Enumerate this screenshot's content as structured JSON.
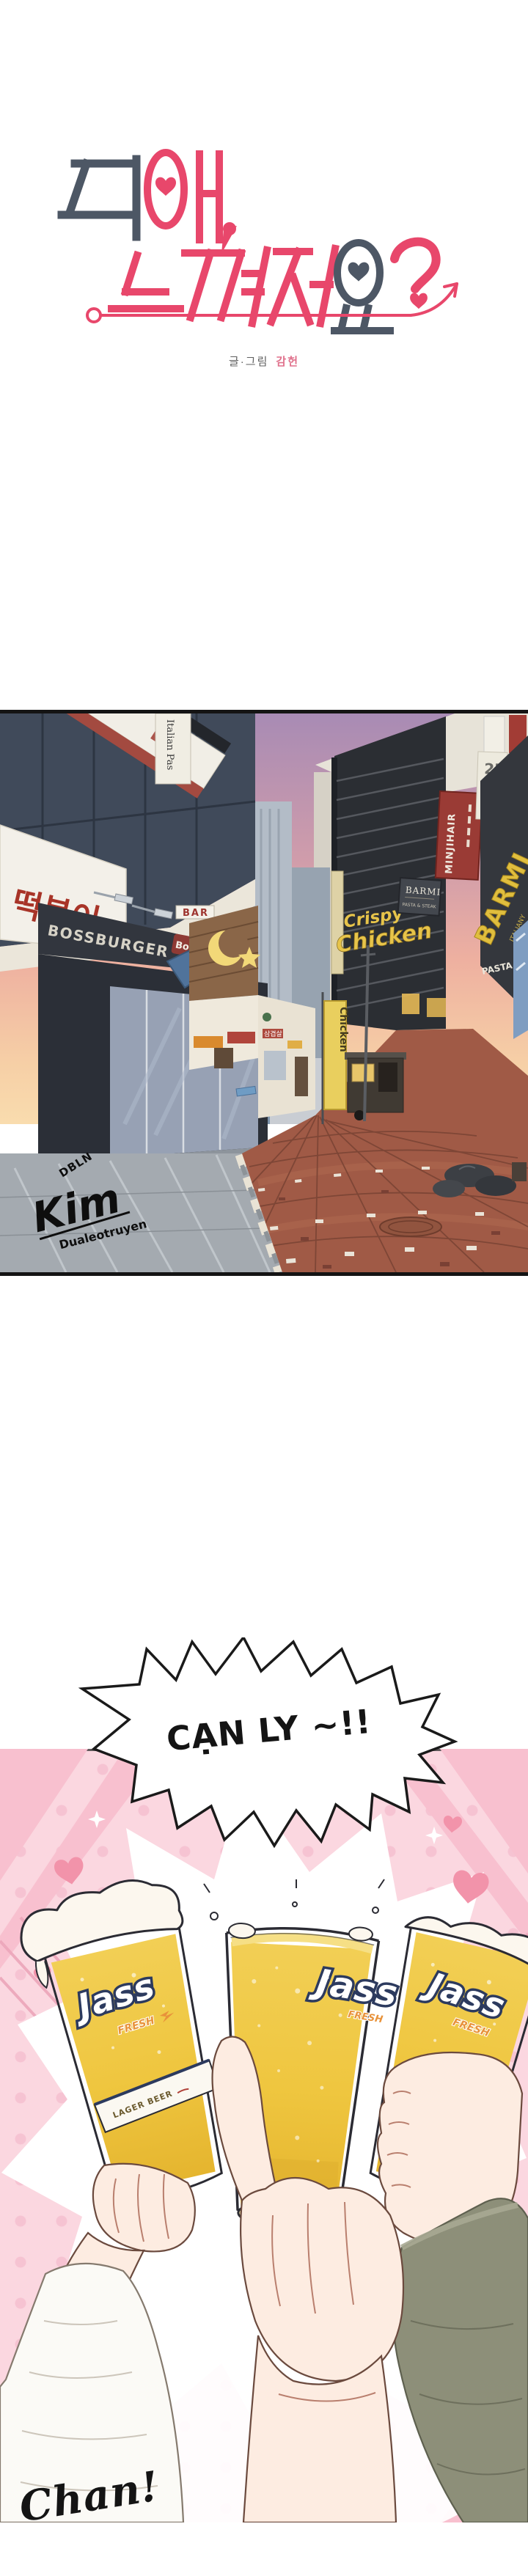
{
  "page": {
    "background": "#ffffff"
  },
  "title_logo": {
    "full_title": "뒤에, 느껴져요?",
    "slate_color": "#4d5765",
    "pink_color": "#e8476b",
    "credit_label": "글·그림",
    "credit_name": "감헌"
  },
  "street_panel": {
    "border_color": "#141414",
    "signs": {
      "italian_pasta_banner": "Italian Pas",
      "tteokbokki_sign": "떡볶이",
      "bar_sign": "BAR",
      "bossburger_sign": "BOSSBURGER",
      "bo_chip": "Bo",
      "bo_logo_b": "B",
      "crispy": "Crispy",
      "chicken": "Chicken",
      "barmi_hanging_title": "BARMI",
      "barmi_hanging_sub": "PASTA & STEAK",
      "minjihair_sign": "MINJIHAIR",
      "floor_sign": "2F",
      "barmi_wall_logo": "BARMI",
      "barmi_wall_italiany": "ITALIANY",
      "barmi_wall_sub": "PASTA & STEAK",
      "samgyeopsal_sign": "삼겹살",
      "chicken_banner": "Chicken"
    },
    "watermark": {
      "line1": "DBLN",
      "line2": "Kim",
      "line3": "Dualeotruyen"
    }
  },
  "speech_bubble": {
    "text": "CẠN LY ~!!",
    "text_color": "#141414"
  },
  "beer_panel": {
    "background_pink": "#fbd7e0",
    "heart_pink": "#f293aa",
    "beer_gold": "#efc63f",
    "brand_navy": "#2c3a5e",
    "brand": "Jass",
    "brand_tagline": "FRESH",
    "label_band_text": "LAGER BEER",
    "sfx_text": "Chan!"
  }
}
